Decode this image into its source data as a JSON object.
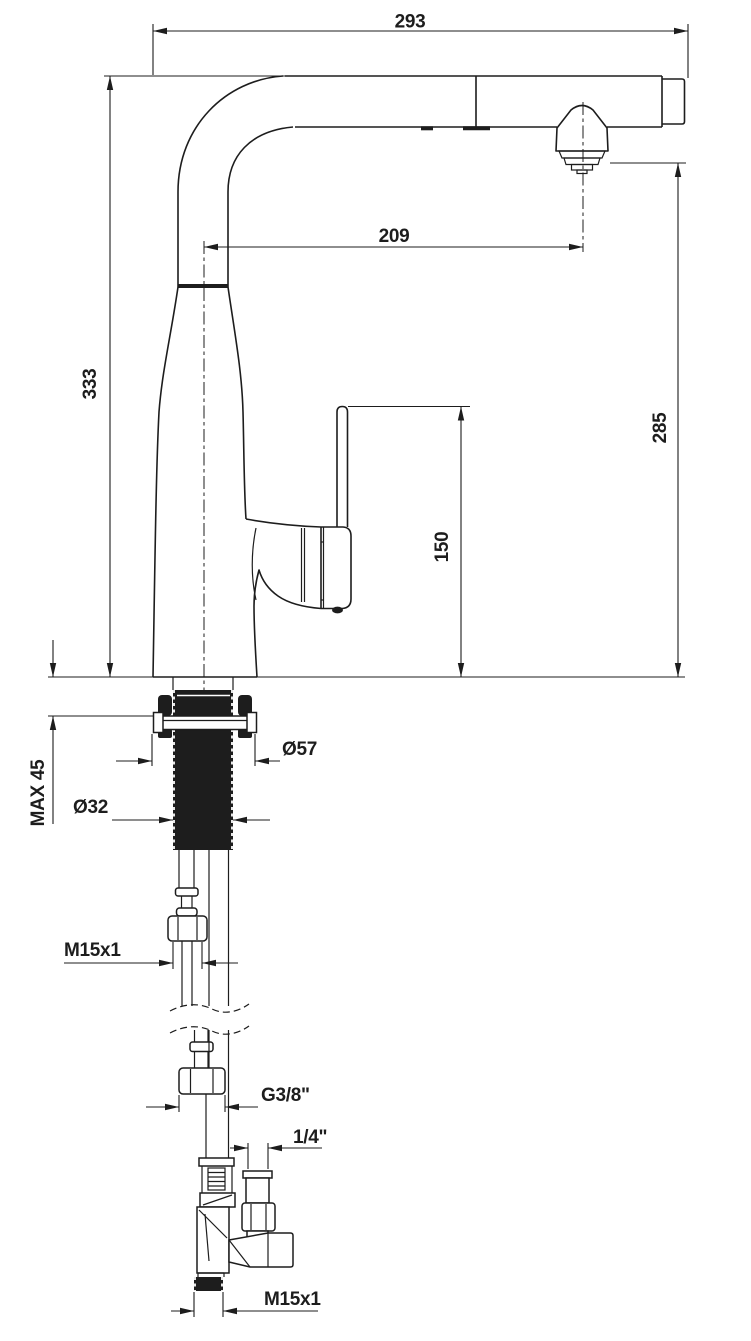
{
  "drawing": {
    "title": "kitchen-faucet-technical-drawing",
    "colors": {
      "line": "#1d1d1d",
      "background": "#ffffff"
    },
    "dimensions": {
      "spout_reach_total": "293",
      "aerator_reach": "209",
      "total_height": "333",
      "aerator_height": "285",
      "handle_height": "150",
      "max_deck_thickness": "MAX 45",
      "base_diameter": "Ø57",
      "shank_diameter": "Ø32",
      "hose_fitting_thread_top": "M15x1",
      "supply_hose_nut_thread": "G3/8\"",
      "filter_branch_thread": "1/4\"",
      "valve_outlet_thread": "M15x1"
    }
  }
}
